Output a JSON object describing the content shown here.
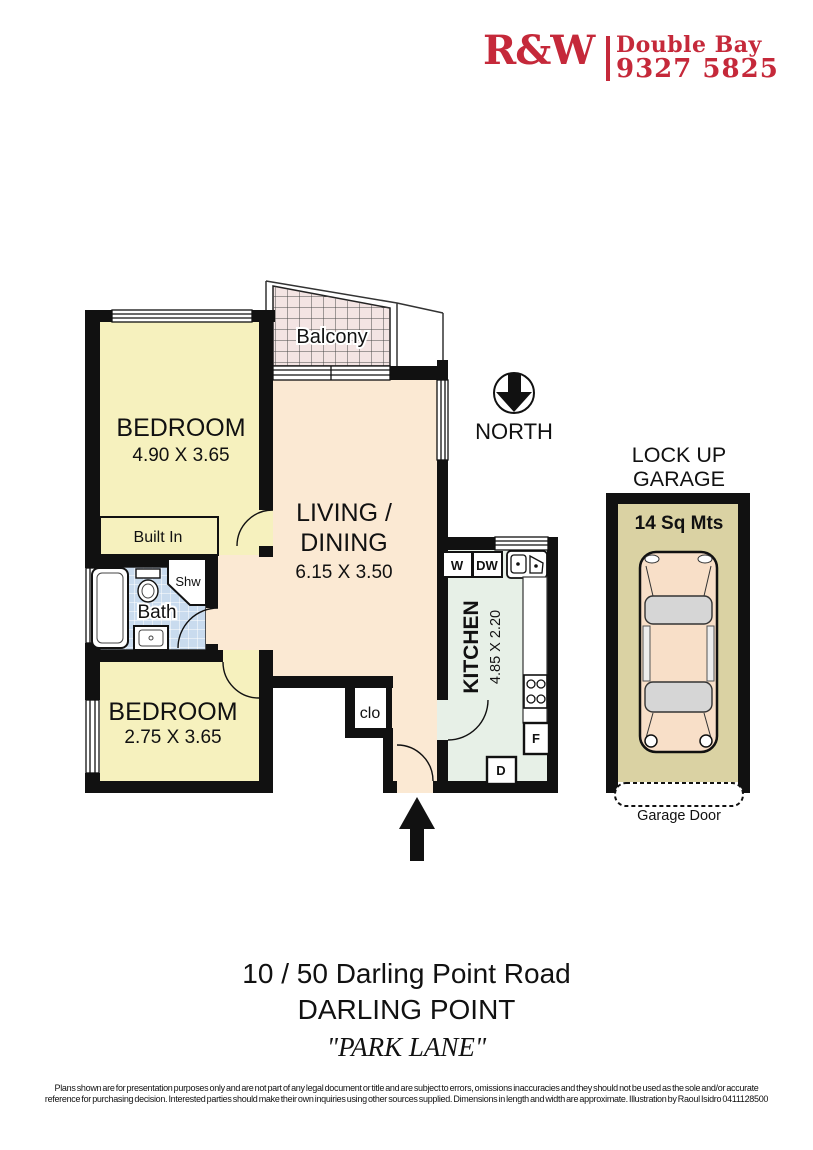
{
  "header": {
    "brand": "R&W",
    "office": "Double Bay",
    "phone": "9327 5825"
  },
  "plan": {
    "north_label": "NORTH",
    "balcony_label": "Balcony",
    "bedroom1": {
      "name": "BEDROOM",
      "dims": "4.90 X 3.65"
    },
    "bedroom2": {
      "name": "BEDROOM",
      "dims": "2.75 X 3.65"
    },
    "living": {
      "line1": "LIVING /",
      "line2": "DINING",
      "dims": "6.15 X 3.50"
    },
    "kitchen": {
      "name": "KITCHEN",
      "dims": "4.85 X 2.20"
    },
    "bath": {
      "name": "Bath",
      "shower": "Shw"
    },
    "built_in": "Built In",
    "closet": "clo",
    "appliances": {
      "washer": "W",
      "dishwasher": "DW",
      "fridge": "F",
      "dryer": "D"
    },
    "garage": {
      "title1": "LOCK UP",
      "title2": "GARAGE",
      "area": "14 Sq Mts",
      "door": "Garage Door"
    }
  },
  "address": {
    "line1": "10 / 50  Darling Point Road",
    "line2": "DARLING POINT",
    "line3": "\"PARK LANE\""
  },
  "disclaimer": {
    "line1": "Plans shown are for presentation purposes only and are not part of any legal document or title and are subject to errors, omissions inaccuracies and they should not be used as the sole and/or accurate",
    "line2": "reference for purchasing decision. Interested parties should make their own inquiries using other sources supplied. Dimensions in length and width are approximate. Illustration by Raoul Isidro 0411128500"
  },
  "colors": {
    "brand_red": "#C5293A",
    "wall": "#111111",
    "bedroom_fill": "#F6F1BE",
    "living_fill": "#FBE9D3",
    "balcony_fill": "#F3E4E3",
    "kitchen_fill": "#E7F0E7",
    "bath_tile_fill": "#C9DBEE",
    "garage_fill": "#DAD2A3",
    "car_fill": "#F8DFC8"
  }
}
